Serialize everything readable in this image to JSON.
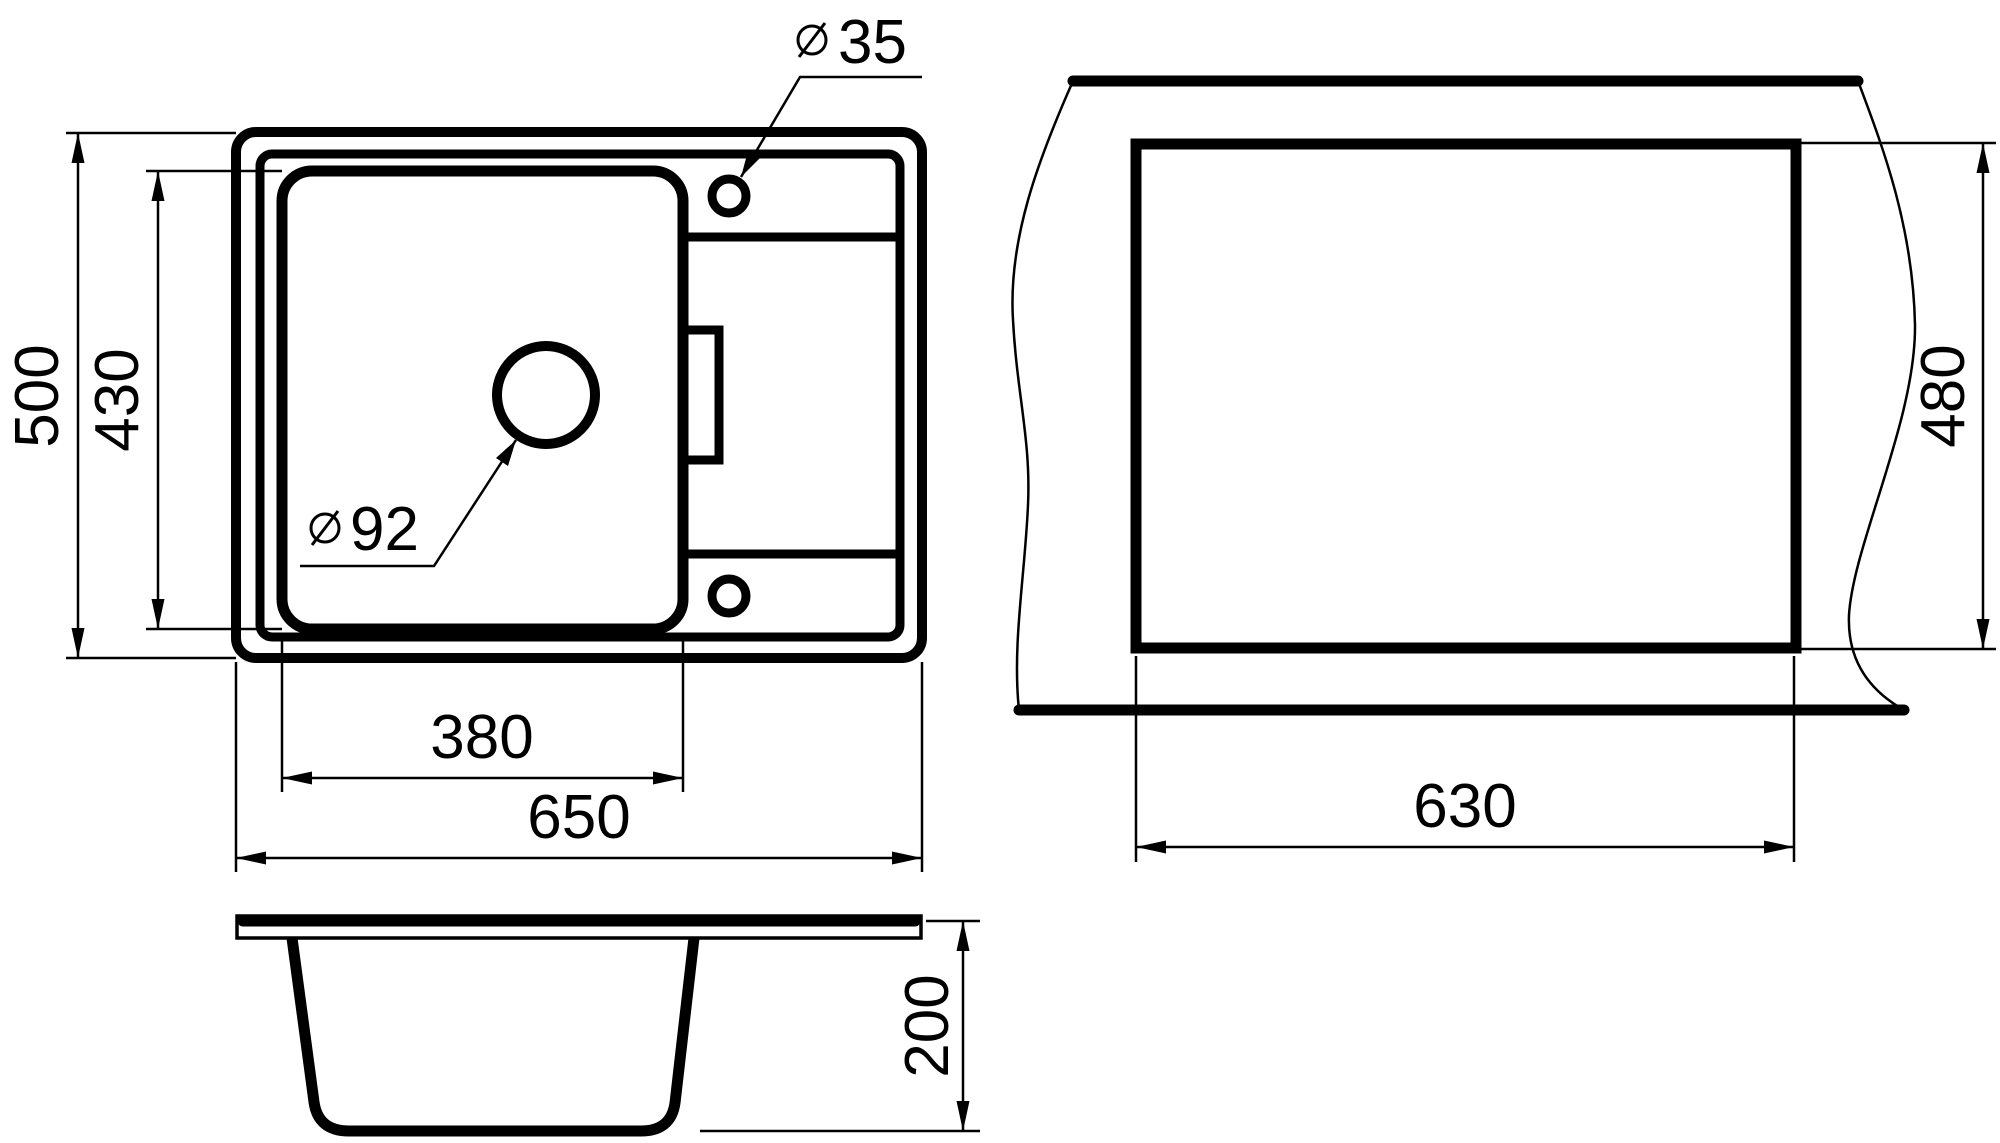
{
  "page": {
    "background": "#ffffff",
    "line_color": "#000000"
  },
  "symbols": {
    "diameter": "⌀"
  },
  "dims": {
    "overall_width": "650",
    "overall_depth": "500",
    "bowl_width": "380",
    "bowl_depth": "430",
    "bowl_height": "200",
    "cutout_width": "630",
    "cutout_depth": "480",
    "faucet_hole_diameter": "35",
    "drain_hole_diameter": "92"
  }
}
